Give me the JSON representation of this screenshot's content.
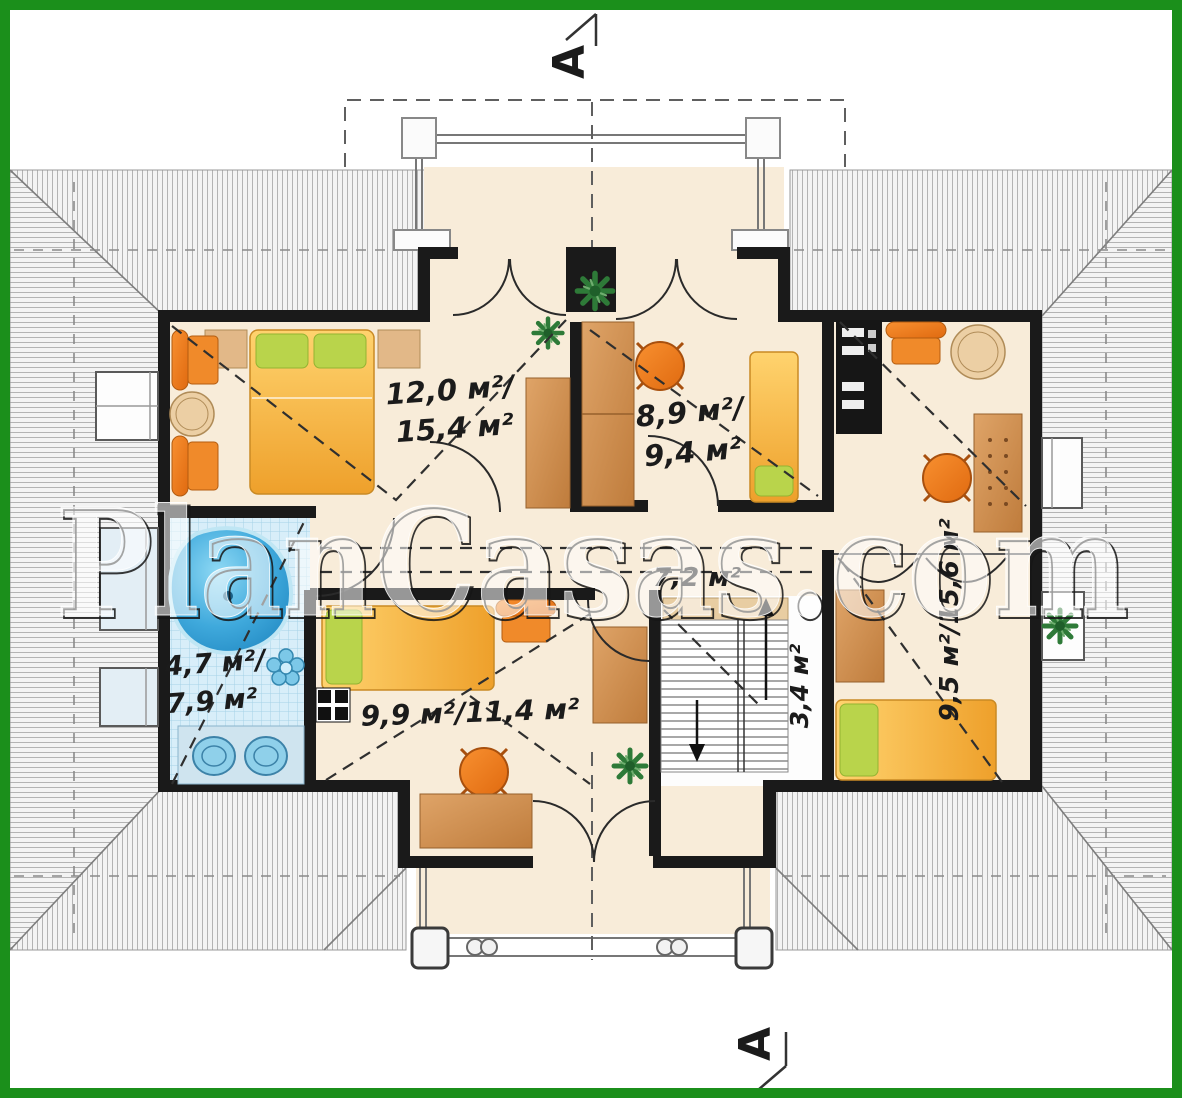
{
  "watermark": {
    "text": "PlanCasas.com"
  },
  "section_markers": {
    "top": "A",
    "bottom": "A"
  },
  "rooms": {
    "bedroom_top_left": {
      "line1": "12,0 м²/",
      "line2": "15,4 м²"
    },
    "room_center": {
      "line1": "8,9 м²/",
      "line2": "9,4 м²"
    },
    "bathroom": {
      "line1": "4,7 м²/",
      "line2": "7,9 м²"
    },
    "bedroom_bottom": {
      "label": "9,9 м²/11,4 м²"
    },
    "room_right": {
      "label": "9,5 м²/15,6 м²"
    },
    "hallway": {
      "label": "7,2 м²"
    },
    "staircase": {
      "label": "3,4 м²"
    }
  },
  "colors": {
    "border_green": "#1b8f1b",
    "wall_black": "#1a1a1a",
    "floor_cream": "#f8ecd9",
    "bath_tile_blue": "#d8eef9",
    "bathtub_blue": "#2f9fd4",
    "bed_yellow": "#f6b23a",
    "pillow_green": "#b9d44b",
    "furniture_orange": "#ef8020",
    "wood_tan": "#d0925a",
    "roof_line_grey": "#b3b3b3"
  }
}
